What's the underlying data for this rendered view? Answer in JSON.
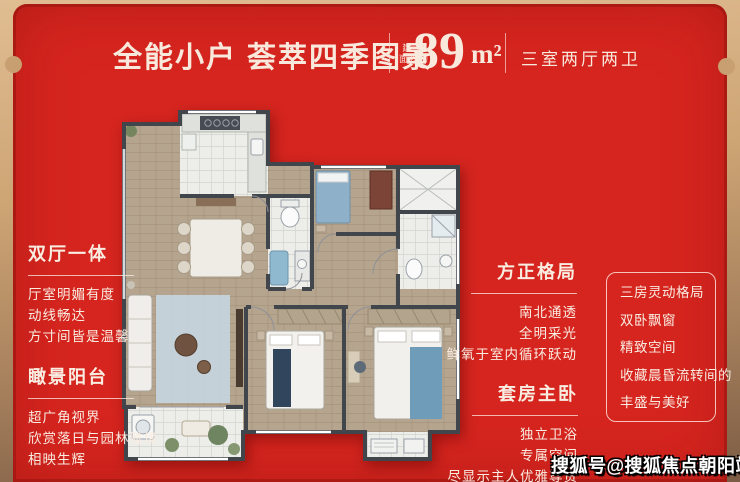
{
  "header": {
    "title": "全能小户 荟萃四季图景",
    "area_prefix_line1": "建 筑",
    "area_prefix_line2": "面积约",
    "area_value": "89",
    "area_unit": "m²",
    "rooms": "三室两厅两卫"
  },
  "callouts": {
    "left_top": {
      "title": "双厅一体",
      "lines": [
        "厅室明媚有度",
        "动线畅达",
        "方寸间皆是温馨"
      ]
    },
    "left_bottom": {
      "title": "瞰景阳台",
      "lines": [
        "超广角视界",
        "欣赏落日与园林雅境",
        "相映生辉"
      ]
    },
    "right_top": {
      "title": "方正格局",
      "lines": [
        "南北通透",
        "全明采光",
        "鲜氧于室内循环跃动"
      ]
    },
    "right_bottom": {
      "title": "套房主卧",
      "lines": [
        "独立卫浴",
        "专属空间",
        "尽显示主人优雅尊贵"
      ]
    }
  },
  "feature_box": {
    "items": [
      "三房灵动格局",
      "双卧飘窗",
      "精致空间",
      "收藏晨昏流转间的",
      "丰盛与美好"
    ]
  },
  "watermark": "搜狐号@搜狐焦点朝阳站",
  "colors": {
    "panel_red": "#d6251f",
    "edge_gold": "#cda474",
    "text_cream": "#f9e9dd",
    "watermark_white": "#ffffff"
  }
}
